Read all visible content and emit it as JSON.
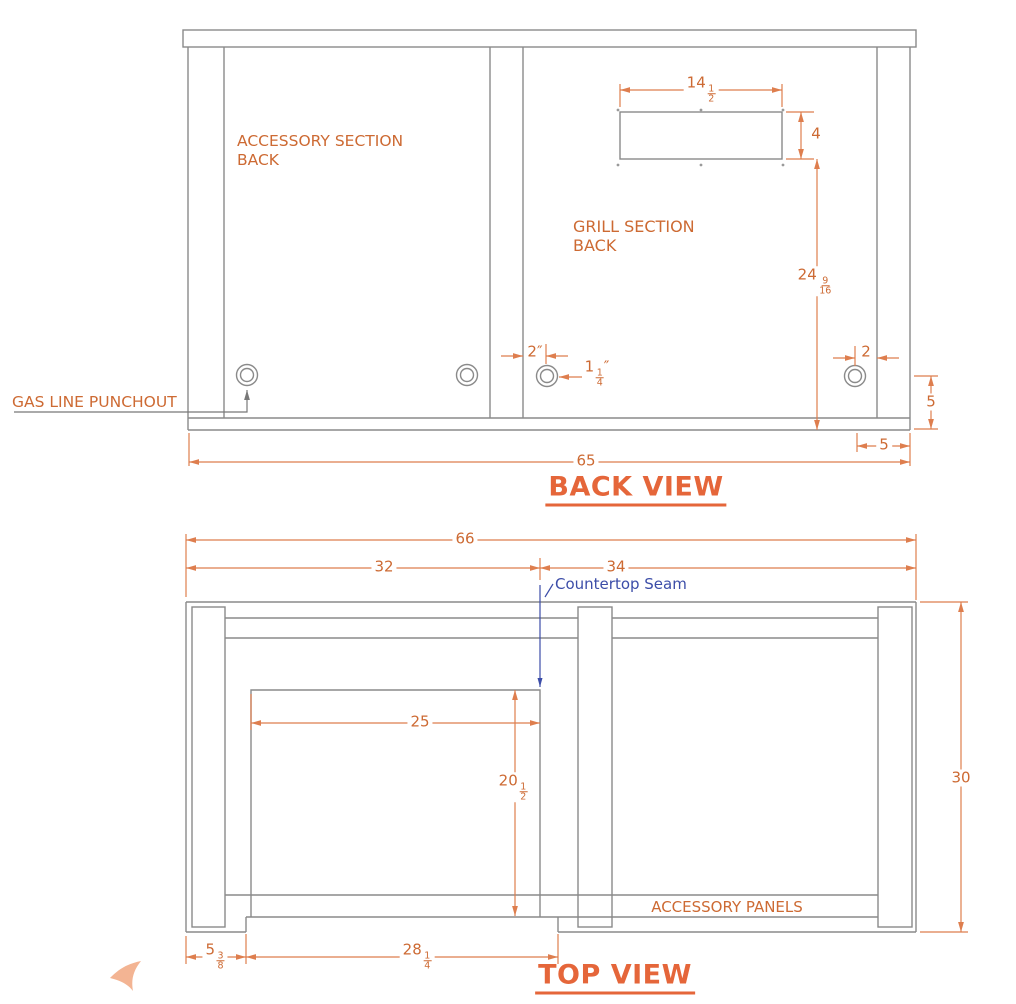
{
  "colors": {
    "line_gray": "#8a8a8a",
    "dim_orange": "#de7e4e",
    "text_orange": "#cd6a33",
    "title_orange": "#e5663a",
    "seam_navy": "#3c4da8",
    "logo_salmon": "#f3b493"
  },
  "back_view": {
    "title": "BACK VIEW",
    "labels": {
      "accessory_line1": "ACCESSORY SECTION",
      "accessory_line2": "BACK",
      "grill_line1": "GRILL SECTION",
      "grill_line2": "BACK",
      "gas_line_punchout": "GAS LINE PUNCHOUT"
    },
    "dims": {
      "cutout_width": {
        "whole": "14",
        "num": "1",
        "den": "2"
      },
      "cutout_height": {
        "whole": "4"
      },
      "right_height": {
        "whole": "24",
        "num": "9",
        "den": "16"
      },
      "punchout_offset_left": {
        "whole": "2″"
      },
      "punchout_diameter": {
        "whole": "1",
        "num": "1",
        "den": "4",
        "suffix": "″"
      },
      "punchout_offset_right": {
        "whole": "2"
      },
      "punchout_center_height": {
        "whole": "5"
      },
      "punchout_right_inset": {
        "whole": "5"
      },
      "overall_width": {
        "whole": "65"
      }
    }
  },
  "top_view": {
    "title": "TOP VIEW",
    "labels": {
      "countertop_seam": "Countertop Seam",
      "accessory_panels": "ACCESSORY PANELS"
    },
    "dims": {
      "overall_width": {
        "whole": "66"
      },
      "grill_section_width": {
        "whole": "32"
      },
      "accessory_section_width": {
        "whole": "34"
      },
      "grill_cutout_width": {
        "whole": "25"
      },
      "grill_cutout_depth": {
        "whole": "20",
        "num": "1",
        "den": "2"
      },
      "overall_depth": {
        "whole": "30"
      },
      "front_notch_offset": {
        "whole": "5",
        "num": "3",
        "den": "8"
      },
      "front_notch_width": {
        "whole": "28",
        "num": "1",
        "den": "4"
      }
    }
  }
}
